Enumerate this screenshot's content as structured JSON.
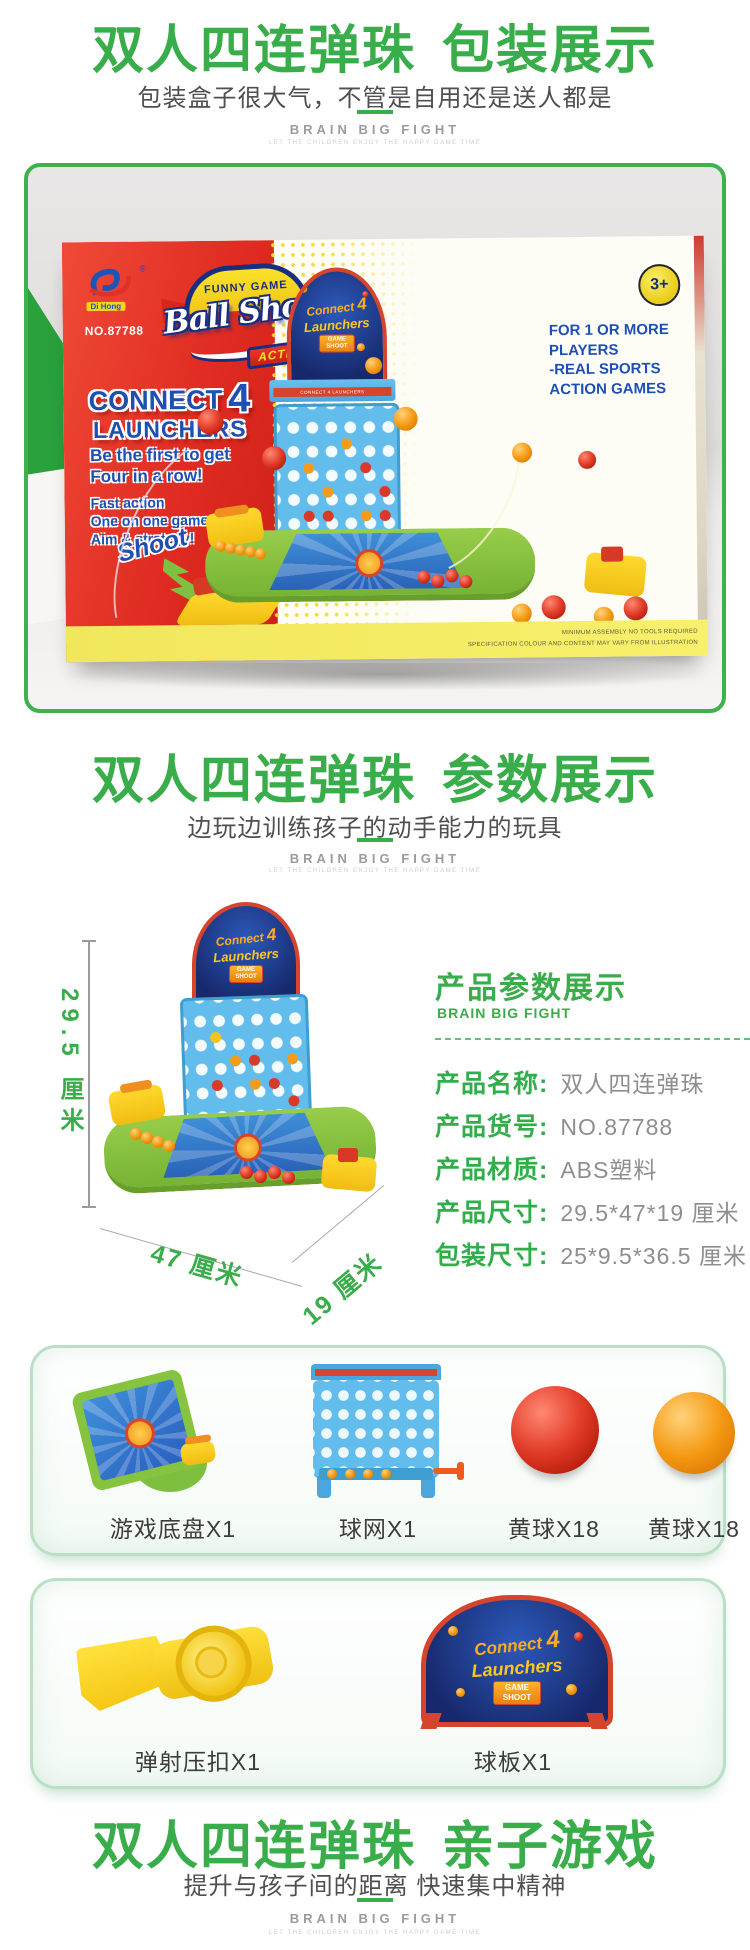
{
  "brand": {
    "name": "BRAIN BIG FIGHT",
    "tagline": "LET THE CHILDREN ENJOY THE HAPPY GAME TIME"
  },
  "sections": {
    "packaging": {
      "title_main": "双人四连弹珠",
      "title_accent": "包装展示",
      "subtitle": "包装盒子很大气，不管是自用还是送人都是"
    },
    "specs": {
      "title_main": "双人四连弹珠",
      "title_accent": "参数展示",
      "subtitle": "边玩边训练孩子的动手能力的玩具"
    },
    "family": {
      "title_main": "双人四连弹珠",
      "title_accent": "亲子游戏",
      "subtitle": "提升与孩子间的距离  快速集中精神"
    }
  },
  "box_art": {
    "logo_brand": "Di Hong",
    "item_no": "NO.87788",
    "banner_top": "FUNNY GAME",
    "logo_script": "Ball Shoot",
    "logo_sub": "ACTIVATE",
    "headline_1": "CONNECT",
    "headline_num": "4",
    "headline_2": "LAUNCHERS",
    "sell_1a": "Be the first to get",
    "sell_1b": "Four in a row!",
    "sell_2a": "Fast action",
    "sell_2b": "One on one game of",
    "sell_2c": "Aim & strategy!",
    "shoot": "Shoot",
    "age": "3+",
    "right_1": "FOR 1 OR MORE",
    "right_2": "PLAYERS",
    "right_3": "-REAL SPORTS",
    "right_4": "ACTION GAMES",
    "fine_1": "MINIMUM ASSEMBLY  NO TOOLS REQUIRED",
    "fine_2": "SPECIFICATION COLOUR AND CONTENT MAY VARY FROM ILLUSTRATION",
    "sign_1": "Connect",
    "sign_num": "4",
    "sign_2": "Launchers",
    "sign_b1": "GAME",
    "sign_b2": "SHOOT",
    "bar_label": "CONNECT 4 LAUNCHERS"
  },
  "spec_panel": {
    "title": "产品参数展示",
    "rows": [
      {
        "label": "产品名称:",
        "value": "双人四连弹珠"
      },
      {
        "label": "产品货号:",
        "value": "NO.87788"
      },
      {
        "label": "产品材质:",
        "value": "ABS塑料"
      },
      {
        "label": "产品尺寸:",
        "value": "29.5*47*19 厘米"
      },
      {
        "label": "包装尺寸:",
        "value": "25*9.5*36.5 厘米"
      }
    ],
    "dim_height": "29.5 厘米",
    "dim_width": "47 厘米",
    "dim_depth": "19 厘米"
  },
  "components": {
    "row1": [
      {
        "label": "游戏底盘X1"
      },
      {
        "label": "球网X1"
      },
      {
        "label": "黄球X18"
      },
      {
        "label": "黄球X18"
      }
    ],
    "row2": [
      {
        "label": "弹射压扣X1"
      },
      {
        "label": "球板X1"
      }
    ]
  },
  "colors": {
    "accent_green": "#39ad4a",
    "box_red": "#e02c22",
    "toy_blue": "#63bdec",
    "base_green": "#85c23d",
    "ball_red": "#d42f1e",
    "ball_orange": "#f59a14"
  }
}
